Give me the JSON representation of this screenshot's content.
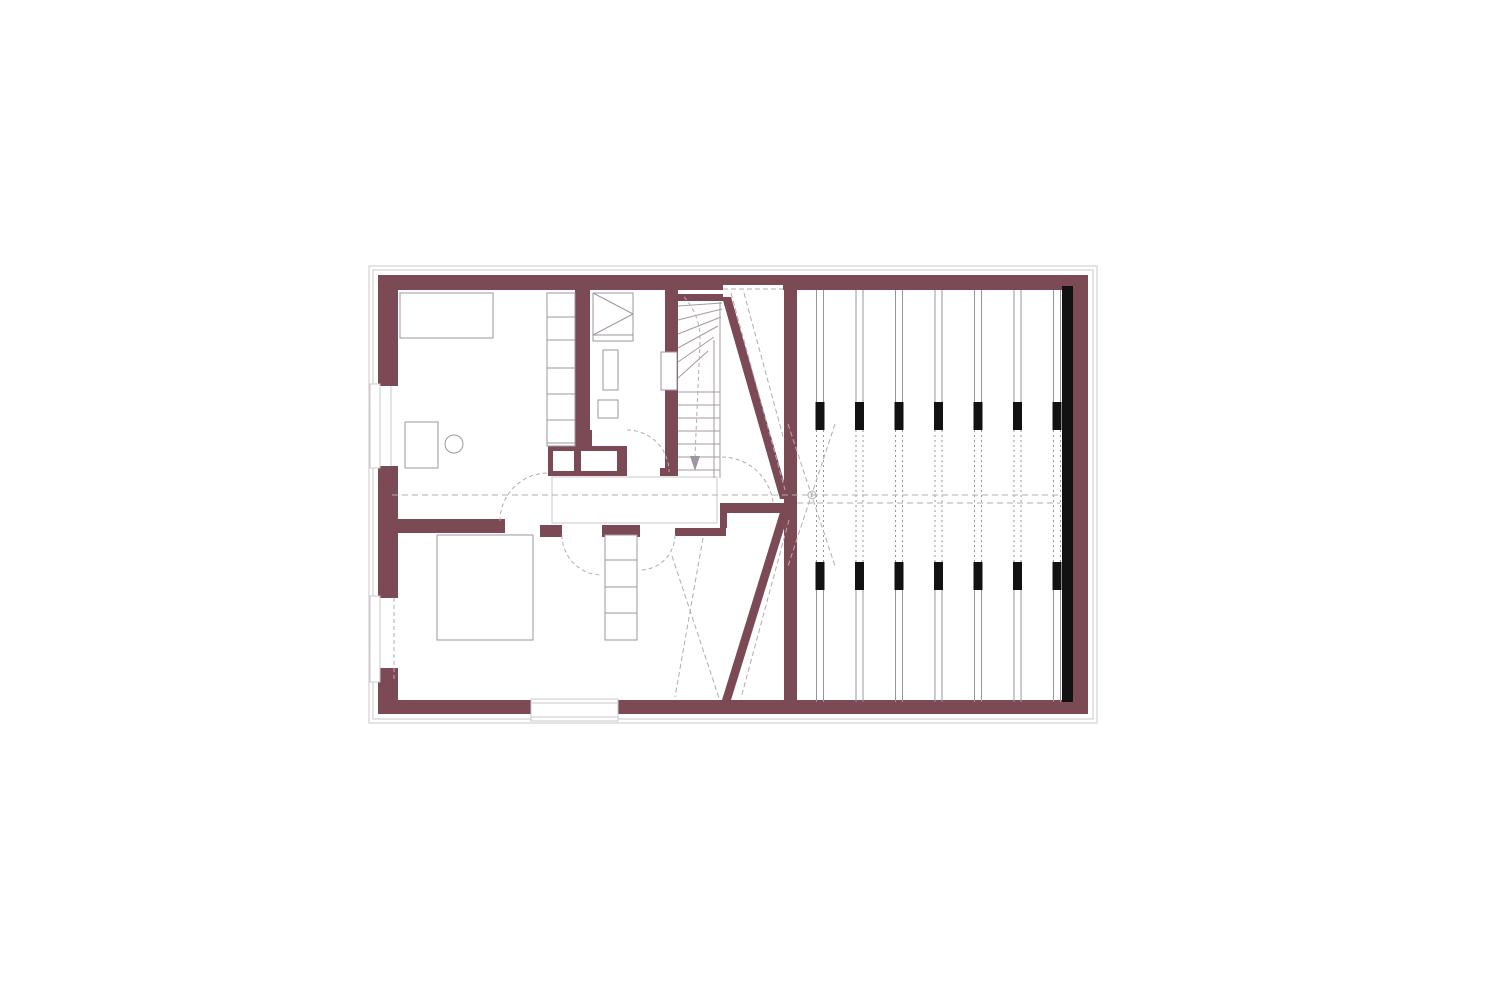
{
  "canvas": {
    "w": 1500,
    "h": 1000,
    "bg": "#ffffff"
  },
  "palette": {
    "wall": "#7b4a54",
    "furn": "#9e96a0",
    "stair": "#a59aa2",
    "light": "#cdc7cd",
    "dash": "#b3abb3",
    "joist": "#9a949a",
    "black": "#121212",
    "white": "#ffffff"
  },
  "elements": [
    {
      "n": "outer-plaster-outline",
      "t": "rect",
      "x": 369,
      "y": 266,
      "w": 728,
      "h": 457,
      "s": "light"
    },
    {
      "n": "inner-plaster-outline",
      "t": "rect",
      "x": 373,
      "y": 270,
      "w": 720,
      "h": 449,
      "s": "light"
    },
    {
      "n": "top-wall",
      "t": "rect",
      "x": 378,
      "y": 275,
      "w": 710,
      "h": 15,
      "f": "wall"
    },
    {
      "n": "top-wall-thin-notch",
      "t": "rect",
      "x": 723,
      "y": 285,
      "w": 60,
      "h": 5,
      "f": "white"
    },
    {
      "n": "left-wall-upper",
      "t": "rect",
      "x": 378,
      "y": 290,
      "w": 20,
      "h": 96,
      "f": "wall"
    },
    {
      "n": "left-wall-middle",
      "t": "rect",
      "x": 378,
      "y": 466,
      "w": 20,
      "h": 132,
      "f": "wall"
    },
    {
      "n": "left-wall-lower",
      "t": "rect",
      "x": 378,
      "y": 668,
      "w": 20,
      "h": 46,
      "f": "wall"
    },
    {
      "n": "bottom-wall",
      "t": "rect",
      "x": 398,
      "y": 700,
      "w": 690,
      "h": 14,
      "f": "wall"
    },
    {
      "n": "right-wall",
      "t": "rect",
      "x": 1072,
      "y": 275,
      "w": 16,
      "h": 439,
      "f": "wall"
    },
    {
      "n": "dividing-wall",
      "t": "rect",
      "x": 784,
      "y": 285,
      "w": 13,
      "h": 417,
      "f": "wall"
    },
    {
      "n": "room-divider-wall",
      "t": "rect",
      "x": 575,
      "y": 290,
      "w": 15,
      "h": 140,
      "f": "wall"
    },
    {
      "n": "room-divider-stub",
      "t": "rect",
      "x": 571,
      "y": 430,
      "w": 21,
      "h": 19,
      "f": "wall"
    },
    {
      "n": "stairwell-left-wall",
      "t": "rect",
      "x": 665,
      "y": 290,
      "w": 13,
      "h": 178,
      "f": "wall"
    },
    {
      "n": "stairwell-wall-foot",
      "t": "rect",
      "x": 660,
      "y": 468,
      "w": 18,
      "h": 8,
      "f": "wall"
    },
    {
      "n": "stairwell-top-wall",
      "t": "rect",
      "x": 678,
      "y": 294,
      "w": 45,
      "h": 7,
      "f": "wall"
    },
    {
      "n": "chimney-block",
      "t": "rect",
      "x": 548,
      "y": 446,
      "w": 79,
      "h": 30,
      "f": "wall"
    },
    {
      "n": "chimney-flue-1",
      "t": "rect",
      "x": 553,
      "y": 451,
      "w": 21,
      "h": 20,
      "f": "white"
    },
    {
      "n": "chimney-flue-2",
      "t": "rect",
      "x": 581,
      "y": 451,
      "w": 36,
      "h": 20,
      "f": "white"
    },
    {
      "n": "room1-bottom-wall",
      "t": "rect",
      "x": 398,
      "y": 519,
      "w": 107,
      "h": 14,
      "f": "wall"
    },
    {
      "n": "hall-wall-a",
      "t": "rect",
      "x": 540,
      "y": 525,
      "w": 22,
      "h": 12,
      "f": "wall"
    },
    {
      "n": "hall-wall-b",
      "t": "rect",
      "x": 602,
      "y": 525,
      "w": 38,
      "h": 12,
      "f": "wall"
    },
    {
      "n": "hall-wall-c",
      "t": "rect",
      "x": 675,
      "y": 528,
      "w": 51,
      "h": 8,
      "f": "wall"
    },
    {
      "n": "hall-wall-step",
      "t": "rect",
      "x": 720,
      "y": 513,
      "w": 7,
      "h": 15,
      "f": "wall"
    },
    {
      "n": "trapezoid-top-wall",
      "t": "rect",
      "x": 720,
      "y": 503,
      "w": 70,
      "h": 10,
      "f": "wall"
    },
    {
      "n": "diagonal-wall-upper",
      "t": "poly",
      "pts": [
        [
          722,
          297
        ],
        [
          731,
          297
        ],
        [
          789,
          499
        ],
        [
          780,
          499
        ]
      ],
      "f": "wall"
    },
    {
      "n": "diagonal-wall-lower",
      "t": "poly",
      "pts": [
        [
          781,
          509
        ],
        [
          790,
          509
        ],
        [
          731,
          700
        ],
        [
          722,
          700
        ]
      ],
      "f": "wall"
    },
    {
      "n": "insulation-strip",
      "t": "rect",
      "x": 1062,
      "y": 286,
      "w": 11,
      "h": 416,
      "f": "black"
    },
    {
      "n": "landing-slab",
      "t": "rect",
      "x": 552,
      "y": 477,
      "w": 165,
      "h": 46,
      "f": "white",
      "s": "light"
    },
    {
      "n": "window-1-frame",
      "t": "rect",
      "x": 370,
      "y": 384,
      "w": 10,
      "h": 84,
      "f": "white",
      "s": "light"
    },
    {
      "n": "window-1-glass",
      "t": "line",
      "x1": 391,
      "y1": 386,
      "x2": 391,
      "y2": 466,
      "s": "light"
    },
    {
      "n": "window-2-frame",
      "t": "rect",
      "x": 370,
      "y": 596,
      "w": 10,
      "h": 86,
      "f": "white",
      "s": "light"
    },
    {
      "n": "window-2-glass",
      "t": "line",
      "x1": 394,
      "y1": 598,
      "x2": 394,
      "y2": 680,
      "s": "dash",
      "d": "4 3"
    },
    {
      "n": "bottom-door-frame",
      "t": "rect",
      "x": 531,
      "y": 699,
      "w": 87,
      "h": 22,
      "f": "white",
      "s": "light"
    },
    {
      "n": "bottom-door-line-1",
      "t": "line",
      "x1": 531,
      "y1": 703,
      "x2": 618,
      "y2": 703,
      "s": "light"
    },
    {
      "n": "bottom-door-line-2",
      "t": "line",
      "x1": 531,
      "y1": 717,
      "x2": 618,
      "y2": 717,
      "s": "light"
    },
    {
      "n": "stair-tread",
      "t": "line",
      "x1": 678,
      "y1": 392,
      "x2": 720,
      "y2": 392,
      "s": "stair"
    },
    {
      "n": "stair-tread",
      "t": "line",
      "x1": 678,
      "y1": 405,
      "x2": 720,
      "y2": 405,
      "s": "stair"
    },
    {
      "n": "stair-tread",
      "t": "line",
      "x1": 678,
      "y1": 418,
      "x2": 720,
      "y2": 418,
      "s": "stair"
    },
    {
      "n": "stair-tread",
      "t": "line",
      "x1": 678,
      "y1": 431,
      "x2": 720,
      "y2": 431,
      "s": "stair"
    },
    {
      "n": "stair-tread",
      "t": "line",
      "x1": 678,
      "y1": 444,
      "x2": 720,
      "y2": 444,
      "s": "stair"
    },
    {
      "n": "stair-tread",
      "t": "line",
      "x1": 678,
      "y1": 457,
      "x2": 720,
      "y2": 457,
      "s": "stair"
    },
    {
      "n": "stair-tread",
      "t": "line",
      "x1": 678,
      "y1": 470,
      "x2": 720,
      "y2": 470,
      "s": "stair"
    },
    {
      "n": "stair-winder",
      "t": "line",
      "x1": 678,
      "y1": 306,
      "x2": 722,
      "y2": 303,
      "s": "stair"
    },
    {
      "n": "stair-winder",
      "t": "line",
      "x1": 678,
      "y1": 320,
      "x2": 722,
      "y2": 309,
      "s": "stair"
    },
    {
      "n": "stair-winder",
      "t": "line",
      "x1": 678,
      "y1": 334,
      "x2": 721,
      "y2": 317,
      "s": "stair"
    },
    {
      "n": "stair-winder",
      "t": "line",
      "x1": 678,
      "y1": 348,
      "x2": 718,
      "y2": 326,
      "s": "stair"
    },
    {
      "n": "stair-winder",
      "t": "line",
      "x1": 678,
      "y1": 362,
      "x2": 714,
      "y2": 337,
      "s": "stair"
    },
    {
      "n": "stair-winder",
      "t": "line",
      "x1": 678,
      "y1": 378,
      "x2": 708,
      "y2": 351,
      "s": "stair"
    },
    {
      "n": "stair-edge-outer",
      "t": "line",
      "x1": 720,
      "y1": 302,
      "x2": 720,
      "y2": 478,
      "s": "stair"
    },
    {
      "n": "stair-edge-inner",
      "t": "line",
      "x1": 714,
      "y1": 340,
      "x2": 714,
      "y2": 478,
      "s": "stair"
    },
    {
      "n": "stair-walk-line",
      "t": "path",
      "dp": "M 684 297 Q 701 316 700 342 L 695 456",
      "s": "dash",
      "d": "4 3"
    },
    {
      "n": "stair-walk-arrow",
      "t": "poly",
      "pts": [
        [
          690,
          456
        ],
        [
          700,
          456
        ],
        [
          695,
          471
        ]
      ],
      "f": "furn"
    },
    {
      "n": "bed-room1",
      "t": "rect",
      "x": 400,
      "y": 293,
      "w": 93,
      "h": 45,
      "s": "furn",
      "f": "white"
    },
    {
      "n": "shelf-room1",
      "t": "rect",
      "x": 547,
      "y": 293,
      "w": 28,
      "h": 153,
      "s": "furn",
      "f": "white"
    },
    {
      "n": "shelf-divider",
      "t": "line",
      "x1": 547,
      "y1": 317,
      "x2": 575,
      "y2": 317,
      "s": "furn"
    },
    {
      "n": "shelf-divider",
      "t": "line",
      "x1": 547,
      "y1": 340,
      "x2": 575,
      "y2": 340,
      "s": "furn"
    },
    {
      "n": "shelf-divider",
      "t": "line",
      "x1": 547,
      "y1": 368,
      "x2": 575,
      "y2": 368,
      "s": "furn"
    },
    {
      "n": "shelf-divider",
      "t": "line",
      "x1": 547,
      "y1": 394,
      "x2": 575,
      "y2": 394,
      "s": "furn"
    },
    {
      "n": "shelf-divider",
      "t": "line",
      "x1": 547,
      "y1": 420,
      "x2": 575,
      "y2": 420,
      "s": "furn"
    },
    {
      "n": "shelf-divider",
      "t": "line",
      "x1": 547,
      "y1": 443,
      "x2": 575,
      "y2": 443,
      "s": "furn"
    },
    {
      "n": "desk-room1",
      "t": "rect",
      "x": 405,
      "y": 422,
      "w": 33,
      "h": 46,
      "s": "furn",
      "f": "white"
    },
    {
      "n": "chair-room1",
      "t": "circle",
      "cx": 454,
      "cy": 444,
      "r": 9,
      "s": "furn",
      "f": "white"
    },
    {
      "n": "wardrobe-room2",
      "t": "rect",
      "x": 593,
      "y": 293,
      "w": 40,
      "h": 42,
      "s": "furn",
      "f": "white"
    },
    {
      "n": "wardrobe-diagonal",
      "t": "line",
      "x1": 593,
      "y1": 293,
      "x2": 633,
      "y2": 314,
      "s": "furn"
    },
    {
      "n": "wardrobe-diagonal",
      "t": "line",
      "x1": 593,
      "y1": 335,
      "x2": 633,
      "y2": 314,
      "s": "furn"
    },
    {
      "n": "wardrobe-base",
      "t": "rect",
      "x": 593,
      "y": 335,
      "w": 40,
      "h": 6,
      "s": "furn",
      "f": "white"
    },
    {
      "n": "fixture-room2-a",
      "t": "rect",
      "x": 603,
      "y": 350,
      "w": 15,
      "h": 40,
      "s": "furn",
      "f": "white"
    },
    {
      "n": "fixture-room2-b",
      "t": "rect",
      "x": 598,
      "y": 400,
      "w": 20,
      "h": 18,
      "s": "furn",
      "f": "white"
    },
    {
      "n": "wall-niche-room2",
      "t": "rect",
      "x": 661,
      "y": 352,
      "w": 16,
      "h": 38,
      "s": "furn",
      "f": "white"
    },
    {
      "n": "bed-room3",
      "t": "rect",
      "x": 437,
      "y": 535,
      "w": 96,
      "h": 105,
      "s": "furn",
      "f": "white"
    },
    {
      "n": "ladder-room3",
      "t": "rect",
      "x": 605,
      "y": 535,
      "w": 32,
      "h": 105,
      "s": "furn",
      "f": "white"
    },
    {
      "n": "ladder-rung",
      "t": "line",
      "x1": 605,
      "y1": 560,
      "x2": 637,
      "y2": 560,
      "s": "furn"
    },
    {
      "n": "ladder-rung",
      "t": "line",
      "x1": 605,
      "y1": 587,
      "x2": 637,
      "y2": 587,
      "s": "furn"
    },
    {
      "n": "ladder-rung",
      "t": "line",
      "x1": 605,
      "y1": 613,
      "x2": 637,
      "y2": 613,
      "s": "furn"
    },
    {
      "n": "joist-array",
      "t": "joists",
      "centers": [
        820,
        859.5,
        899,
        938.5,
        978,
        1017.5,
        1057
      ],
      "gap": 7,
      "solid": [
        [
          290,
          402
        ],
        [
          590,
          702
        ]
      ],
      "dashed": [
        [
          430,
          562
        ]
      ],
      "blocks": [
        [
          402,
          28
        ],
        [
          562,
          28
        ]
      ],
      "bw": 9
    },
    {
      "n": "center-axis-dash",
      "t": "line",
      "x1": 392,
      "y1": 495,
      "x2": 1060,
      "y2": 495,
      "s": "dash",
      "d": "6 4"
    },
    {
      "n": "ridge-axis-dash",
      "t": "line",
      "x1": 797,
      "y1": 503,
      "x2": 1060,
      "y2": 503,
      "s": "dash",
      "d": "6 4"
    },
    {
      "n": "trapezoid-top-dash",
      "t": "line",
      "x1": 723,
      "y1": 289,
      "x2": 783,
      "y2": 289,
      "s": "dash",
      "d": "5 3"
    },
    {
      "n": "roofline-dash",
      "t": "line",
      "x1": 731,
      "y1": 293,
      "x2": 785,
      "y2": 490,
      "s": "dash",
      "d": "5 3"
    },
    {
      "n": "roofline-dash",
      "t": "line",
      "x1": 744,
      "y1": 293,
      "x2": 784,
      "y2": 440,
      "s": "dash",
      "d": "5 3"
    },
    {
      "n": "roofline-dash",
      "t": "line",
      "x1": 789,
      "y1": 520,
      "x2": 741,
      "y2": 698,
      "s": "dash",
      "d": "5 3"
    },
    {
      "n": "axis-cross-dash",
      "t": "line",
      "x1": 788,
      "y1": 424,
      "x2": 835,
      "y2": 566,
      "s": "dash",
      "d": "5 3"
    },
    {
      "n": "axis-cross-dash",
      "t": "line",
      "x1": 835,
      "y1": 424,
      "x2": 788,
      "y2": 566,
      "s": "dash",
      "d": "5 3"
    },
    {
      "n": "axis-marker-circle",
      "t": "circle",
      "cx": 812,
      "cy": 495,
      "r": 4,
      "s": "dash",
      "f": "none"
    },
    {
      "n": "headroom-dash-room3",
      "t": "line",
      "x1": 703,
      "y1": 538,
      "x2": 675,
      "y2": 697,
      "s": "dash",
      "d": "5 3"
    },
    {
      "n": "headroom-dash-room3",
      "t": "line",
      "x1": 672,
      "y1": 556,
      "x2": 719,
      "y2": 698,
      "s": "dash",
      "d": "5 3"
    },
    {
      "n": "door-swing-room1",
      "t": "path",
      "dp": "M 500 521 A 48 48 0 0 1 548 473",
      "s": "dash",
      "d": "4 3"
    },
    {
      "n": "door-swing-room2",
      "t": "path",
      "dp": "M 627 430 A 42 42 0 0 1 669 472",
      "s": "dash",
      "d": "4 3"
    },
    {
      "n": "door-swing-room3-a",
      "t": "path",
      "dp": "M 562 535 A 40 40 0 0 0 602 575",
      "s": "dash",
      "d": "4 3"
    },
    {
      "n": "door-swing-room3-b",
      "t": "path",
      "dp": "M 675 535 A 35 35 0 0 1 640 570",
      "s": "dash",
      "d": "4 3"
    },
    {
      "n": "door-swing-stair",
      "t": "path",
      "dp": "M 722 457 A 52 52 0 0 1 773 502",
      "s": "dash",
      "d": "4 3"
    }
  ]
}
